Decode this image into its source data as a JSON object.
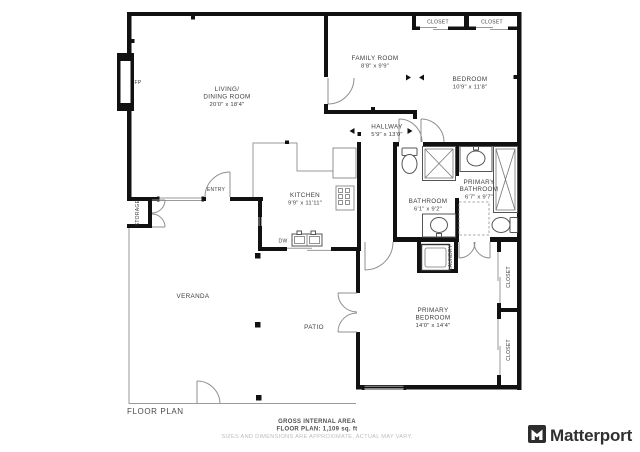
{
  "floor_plan": {
    "title": "FLOOR PLAN",
    "rooms": {
      "living": {
        "line1": "LIVING/",
        "line2": "DINING ROOM",
        "dims": "20'0\" x 18'4\""
      },
      "family": {
        "line1": "FAMILY ROOM",
        "dims": "8'8\" x 9'9\""
      },
      "bedroom": {
        "line1": "BEDROOM",
        "dims": "10'9\" x 11'8\""
      },
      "hallway": {
        "line1": "HALLWAY",
        "dims": "5'9\" x 13'0\""
      },
      "kitchen": {
        "line1": "KITCHEN",
        "dims": "9'9\" x 11'11\""
      },
      "bathroom": {
        "line1": "BATHROOM",
        "dims": "6'1\" x 9'2\""
      },
      "primary_bathroom": {
        "line1": "PRIMARY",
        "line2": "BATHROOM",
        "dims": "6'7\" x 9'7\""
      },
      "primary_bedroom": {
        "line1": "PRIMARY",
        "line2": "BEDROOM",
        "dims": "14'0\" x 14'4\""
      }
    },
    "annotations": {
      "fireplace": "FP",
      "entry": "ENTRY",
      "storage": "STORAGE",
      "veranda": "VERANDA",
      "patio": "PATIO",
      "dishwasher": "DW",
      "laundry": "LAUNDRY",
      "closet_top_left": "CLOSET",
      "closet_top_right": "CLOSET",
      "closet_right_upper": "CLOSET",
      "closet_right_lower": "CLOSET"
    },
    "footer": {
      "area_label": "GROSS INTERNAL AREA",
      "area_value": "FLOOR PLAN: 1,109 sq. ft",
      "disclaimer": "SIZES AND DIMENSIONS ARE APPROXIMATE, ACTUAL MAY VARY."
    },
    "brand": {
      "name": "Matterport"
    },
    "colors": {
      "wall": "#111111",
      "thin_line": "#9a9a9a",
      "fixture": "#555555",
      "label": "#3d3d3d",
      "muted": "#bcbcbc",
      "brand": "#303030"
    }
  }
}
